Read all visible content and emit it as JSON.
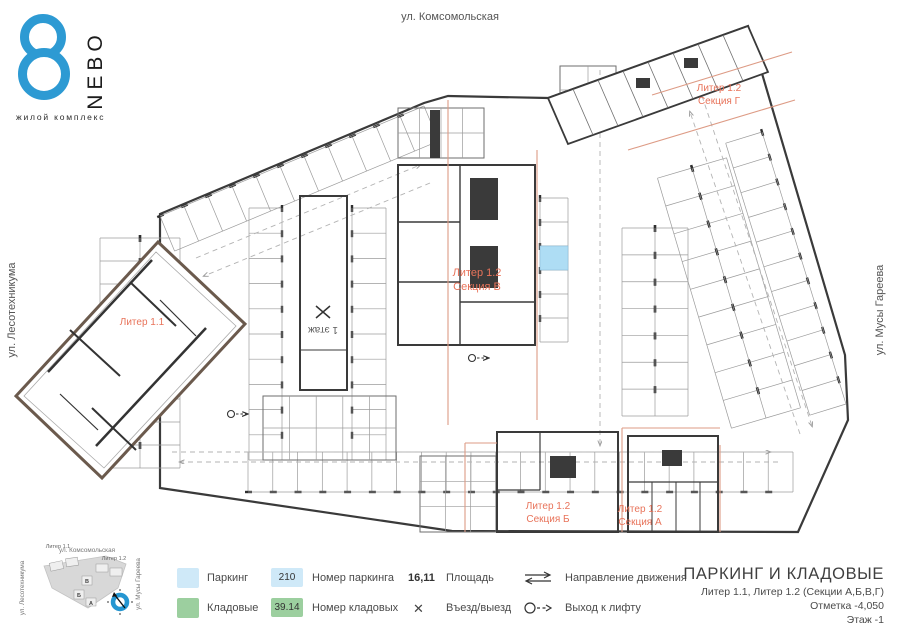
{
  "logo": {
    "name": "NEBO",
    "tagline": "жилой комплекс",
    "accent": "#2d9ad3"
  },
  "streets": {
    "top": "ул. Комсомольская",
    "left": "ул. Лесотехникума",
    "right": "ул. Мусы Гареева"
  },
  "plan": {
    "labels": {
      "liter11": "Литер 1.1",
      "g1": "Литер 1.2",
      "g2": "Секция Г",
      "v1": "Литер 1.2",
      "v2": "Секция В",
      "b1": "Литер 1.2",
      "b2": "Секция Б",
      "a1": "Литер 1.2",
      "a2": "Секция А",
      "floor1": "1 этаж"
    },
    "colors": {
      "section_label": "#e8735a",
      "section_line": "#dd9b85",
      "walls": "#3a3a3a",
      "parking_highlight": "#aeddf4"
    }
  },
  "legend": {
    "parking_label": "Паркинг",
    "storage_label": "Кладовые",
    "parking_number": "210",
    "parking_number_label": "Номер паркинга",
    "storage_number": "39.14",
    "storage_number_label": "Номер кладовых",
    "area_value": "16,11",
    "area_label": "Площадь",
    "entry_symbol": "✕",
    "entry_label": "Въезд/выезд",
    "direction_label": "Направление движения",
    "lift_label": "Выход к лифту",
    "colors": {
      "parking": "#cfe9f8",
      "storage": "#9ccf9f"
    }
  },
  "titleblock": {
    "title": "ПАРКИНГ И КЛАДОВЫЕ",
    "line1": "Литер 1.1, Литер 1.2 (Секции А,Б,В,Г)",
    "line2": "Отметка  -4,050",
    "line3": "Этаж  -1"
  },
  "minimap": {
    "street_top": "ул. Комсомольская",
    "street_left": "ул. Лесотехникума",
    "street_right": "ул. Мусы Гареева",
    "liter11": "Литер 1.1",
    "liter12": "Литер 1.2",
    "section_v": "В",
    "section_b": "Б",
    "section_a": "А"
  }
}
